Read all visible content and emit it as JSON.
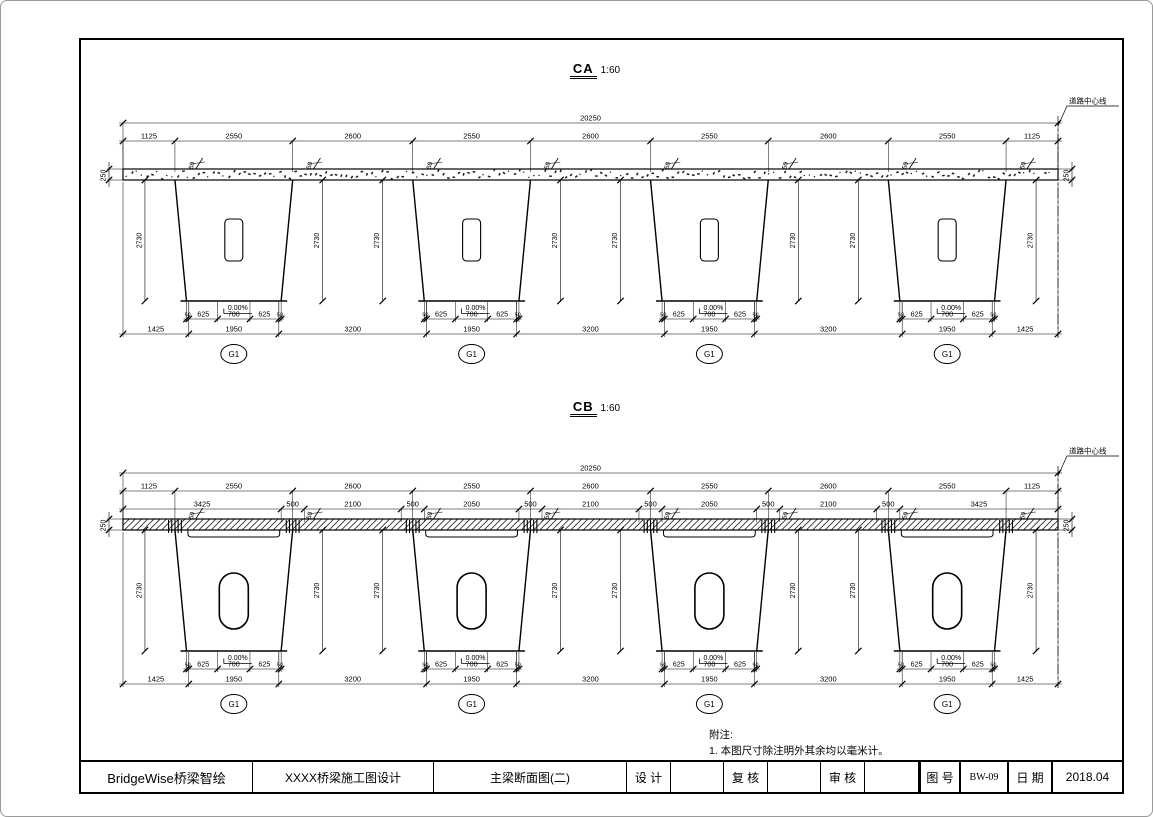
{
  "sections": [
    {
      "name": "CA",
      "scale": "1:60",
      "centerline_label": "道路中心线",
      "deck_hatch": "speckled",
      "labels": {
        "deck_thickness": "250",
        "haunch": "50",
        "girder_height": "2730",
        "slope": "0.00%",
        "girder_tag": "G1"
      },
      "dims": {
        "total": 20250,
        "spacing_row": [
          1125,
          2550,
          2600,
          2550,
          2600,
          2550,
          2600,
          2550,
          1125
        ],
        "bottom_sub": [
          50,
          625,
          700,
          625,
          50
        ],
        "bottom_main": [
          1425,
          1950,
          3200,
          1950,
          3200,
          1950,
          3200,
          1950,
          1425
        ]
      }
    },
    {
      "name": "CB",
      "scale": "1:60",
      "centerline_label": "道路中心线",
      "deck_hatch": "diagonal",
      "labels": {
        "deck_thickness": "250",
        "haunch": "50",
        "girder_height": "2730",
        "slope": "0.00%",
        "girder_tag": "G1"
      },
      "dims": {
        "total": 20250,
        "spacing_row": [
          1125,
          2550,
          2600,
          2550,
          2600,
          2550,
          2600,
          2550,
          1125
        ],
        "joint_row": [
          3425,
          500,
          2100,
          500,
          2050,
          500,
          2100,
          500,
          2050,
          500,
          2100,
          500,
          3425
        ],
        "bottom_sub": [
          50,
          625,
          700,
          625,
          50
        ],
        "bottom_main": [
          1425,
          1950,
          3200,
          1950,
          3200,
          1950,
          3200,
          1950,
          1425
        ]
      }
    }
  ],
  "notes": {
    "title": "附注:",
    "items": [
      "1. 本图尺寸除注明外其余均以毫米计。"
    ]
  },
  "title_block": {
    "company": "BridgeWise桥梁智绘",
    "project": "XXXX桥梁施工图设计",
    "sheet_title": "主梁断面图(二)",
    "fields": [
      {
        "label": "设 计",
        "value": ""
      },
      {
        "label": "复 核",
        "value": ""
      },
      {
        "label": "审 核",
        "value": ""
      }
    ],
    "drawing_no_label": "图 号",
    "drawing_no": "BW-09",
    "date_label": "日 期",
    "date": "2018.04"
  },
  "colors": {
    "line": "#000000",
    "background": "#ffffff"
  }
}
